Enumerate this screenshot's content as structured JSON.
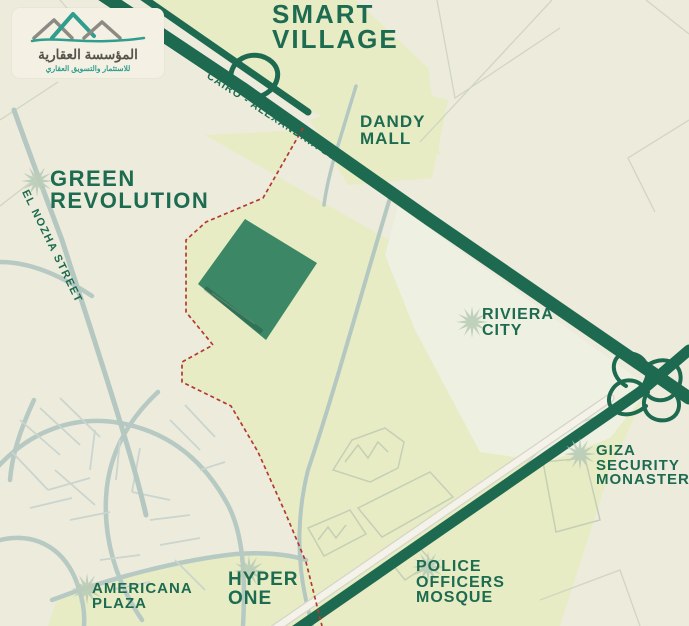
{
  "brand": {
    "name_ar": "المؤسسة العقارية",
    "tagline_ar": "للاستثمار والتسويق العقاري"
  },
  "map": {
    "places": {
      "smart_village": [
        "SMART",
        "VILLAGE"
      ],
      "dandy_mall": [
        "DANDY",
        "MALL"
      ],
      "green_revolution": [
        "GREEN",
        "REVOLUTION"
      ],
      "riviera_city": [
        "RIVIERA",
        "CITY"
      ],
      "giza_security_monastery": [
        "GIZA",
        "SECURITY",
        "MONASTERY"
      ],
      "police_officers_mosque": [
        "POLICE",
        "OFFICERS",
        "MOSQUE"
      ],
      "hyper_one": [
        "HYPER",
        "ONE"
      ],
      "americana_plaza": [
        "AMERICANA",
        "PLAZA"
      ]
    },
    "roads": {
      "cairo_alexandria_desert_rd": "CAIRO - ALEXANDRIA DESERT Rd",
      "el_nozha_street": "EL NOZHA STREET"
    },
    "colors": {
      "highway_green": "#1e6a50",
      "label_green": "#1d6b50",
      "plot_green": "#3b8766",
      "boundary_red": "#b23a33",
      "parcel_yellow_green": "#e7ecc4",
      "background_cream": "#edebdc",
      "road_gray_green": "#b6c9c3",
      "marker_sage": "#bccdb8"
    }
  }
}
